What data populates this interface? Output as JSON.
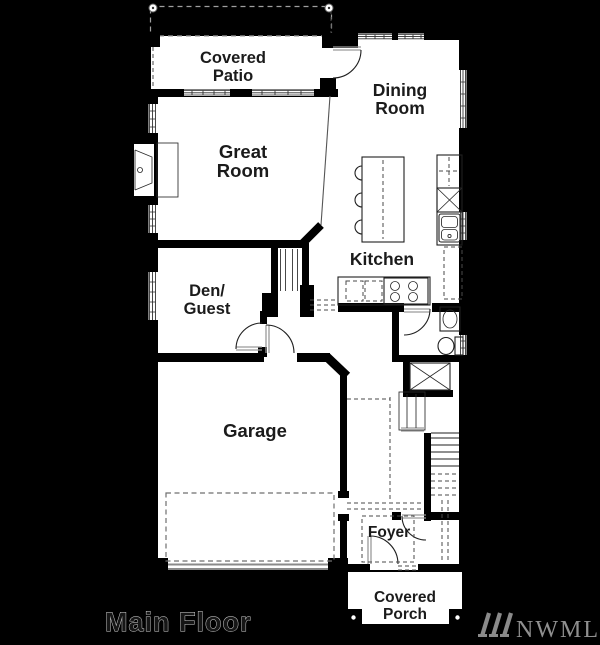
{
  "floor_plan": {
    "rooms": {
      "covered_patio": {
        "line1": "Covered",
        "line2": "Patio"
      },
      "dining_room": {
        "line1": "Dining",
        "line2": "Room"
      },
      "great_room": {
        "line1": "Great",
        "line2": "Room"
      },
      "kitchen": {
        "label": "Kitchen"
      },
      "den_guest": {
        "line1": "Den/",
        "line2": "Guest"
      },
      "garage": {
        "label": "Garage"
      },
      "foyer": {
        "label": "Foyer"
      },
      "covered_porch": {
        "line1": "Covered",
        "line2": "Porch"
      }
    },
    "caption": "Main Floor",
    "watermark": "NWMLS",
    "colors": {
      "background": "#000000",
      "floor": "#ffffff",
      "walls": "#000000",
      "detail_gray": "#8a8a8a",
      "watermark_gray": "#8f8f8f"
    },
    "fixtures": [
      "fireplace",
      "kitchen-island",
      "bar-stools",
      "range",
      "double-sink",
      "refrigerator",
      "dishwasher",
      "pantry-counter",
      "vanity-sink",
      "toilet",
      "closet",
      "stairs",
      "garage-parking-pad",
      "porch-posts"
    ]
  }
}
